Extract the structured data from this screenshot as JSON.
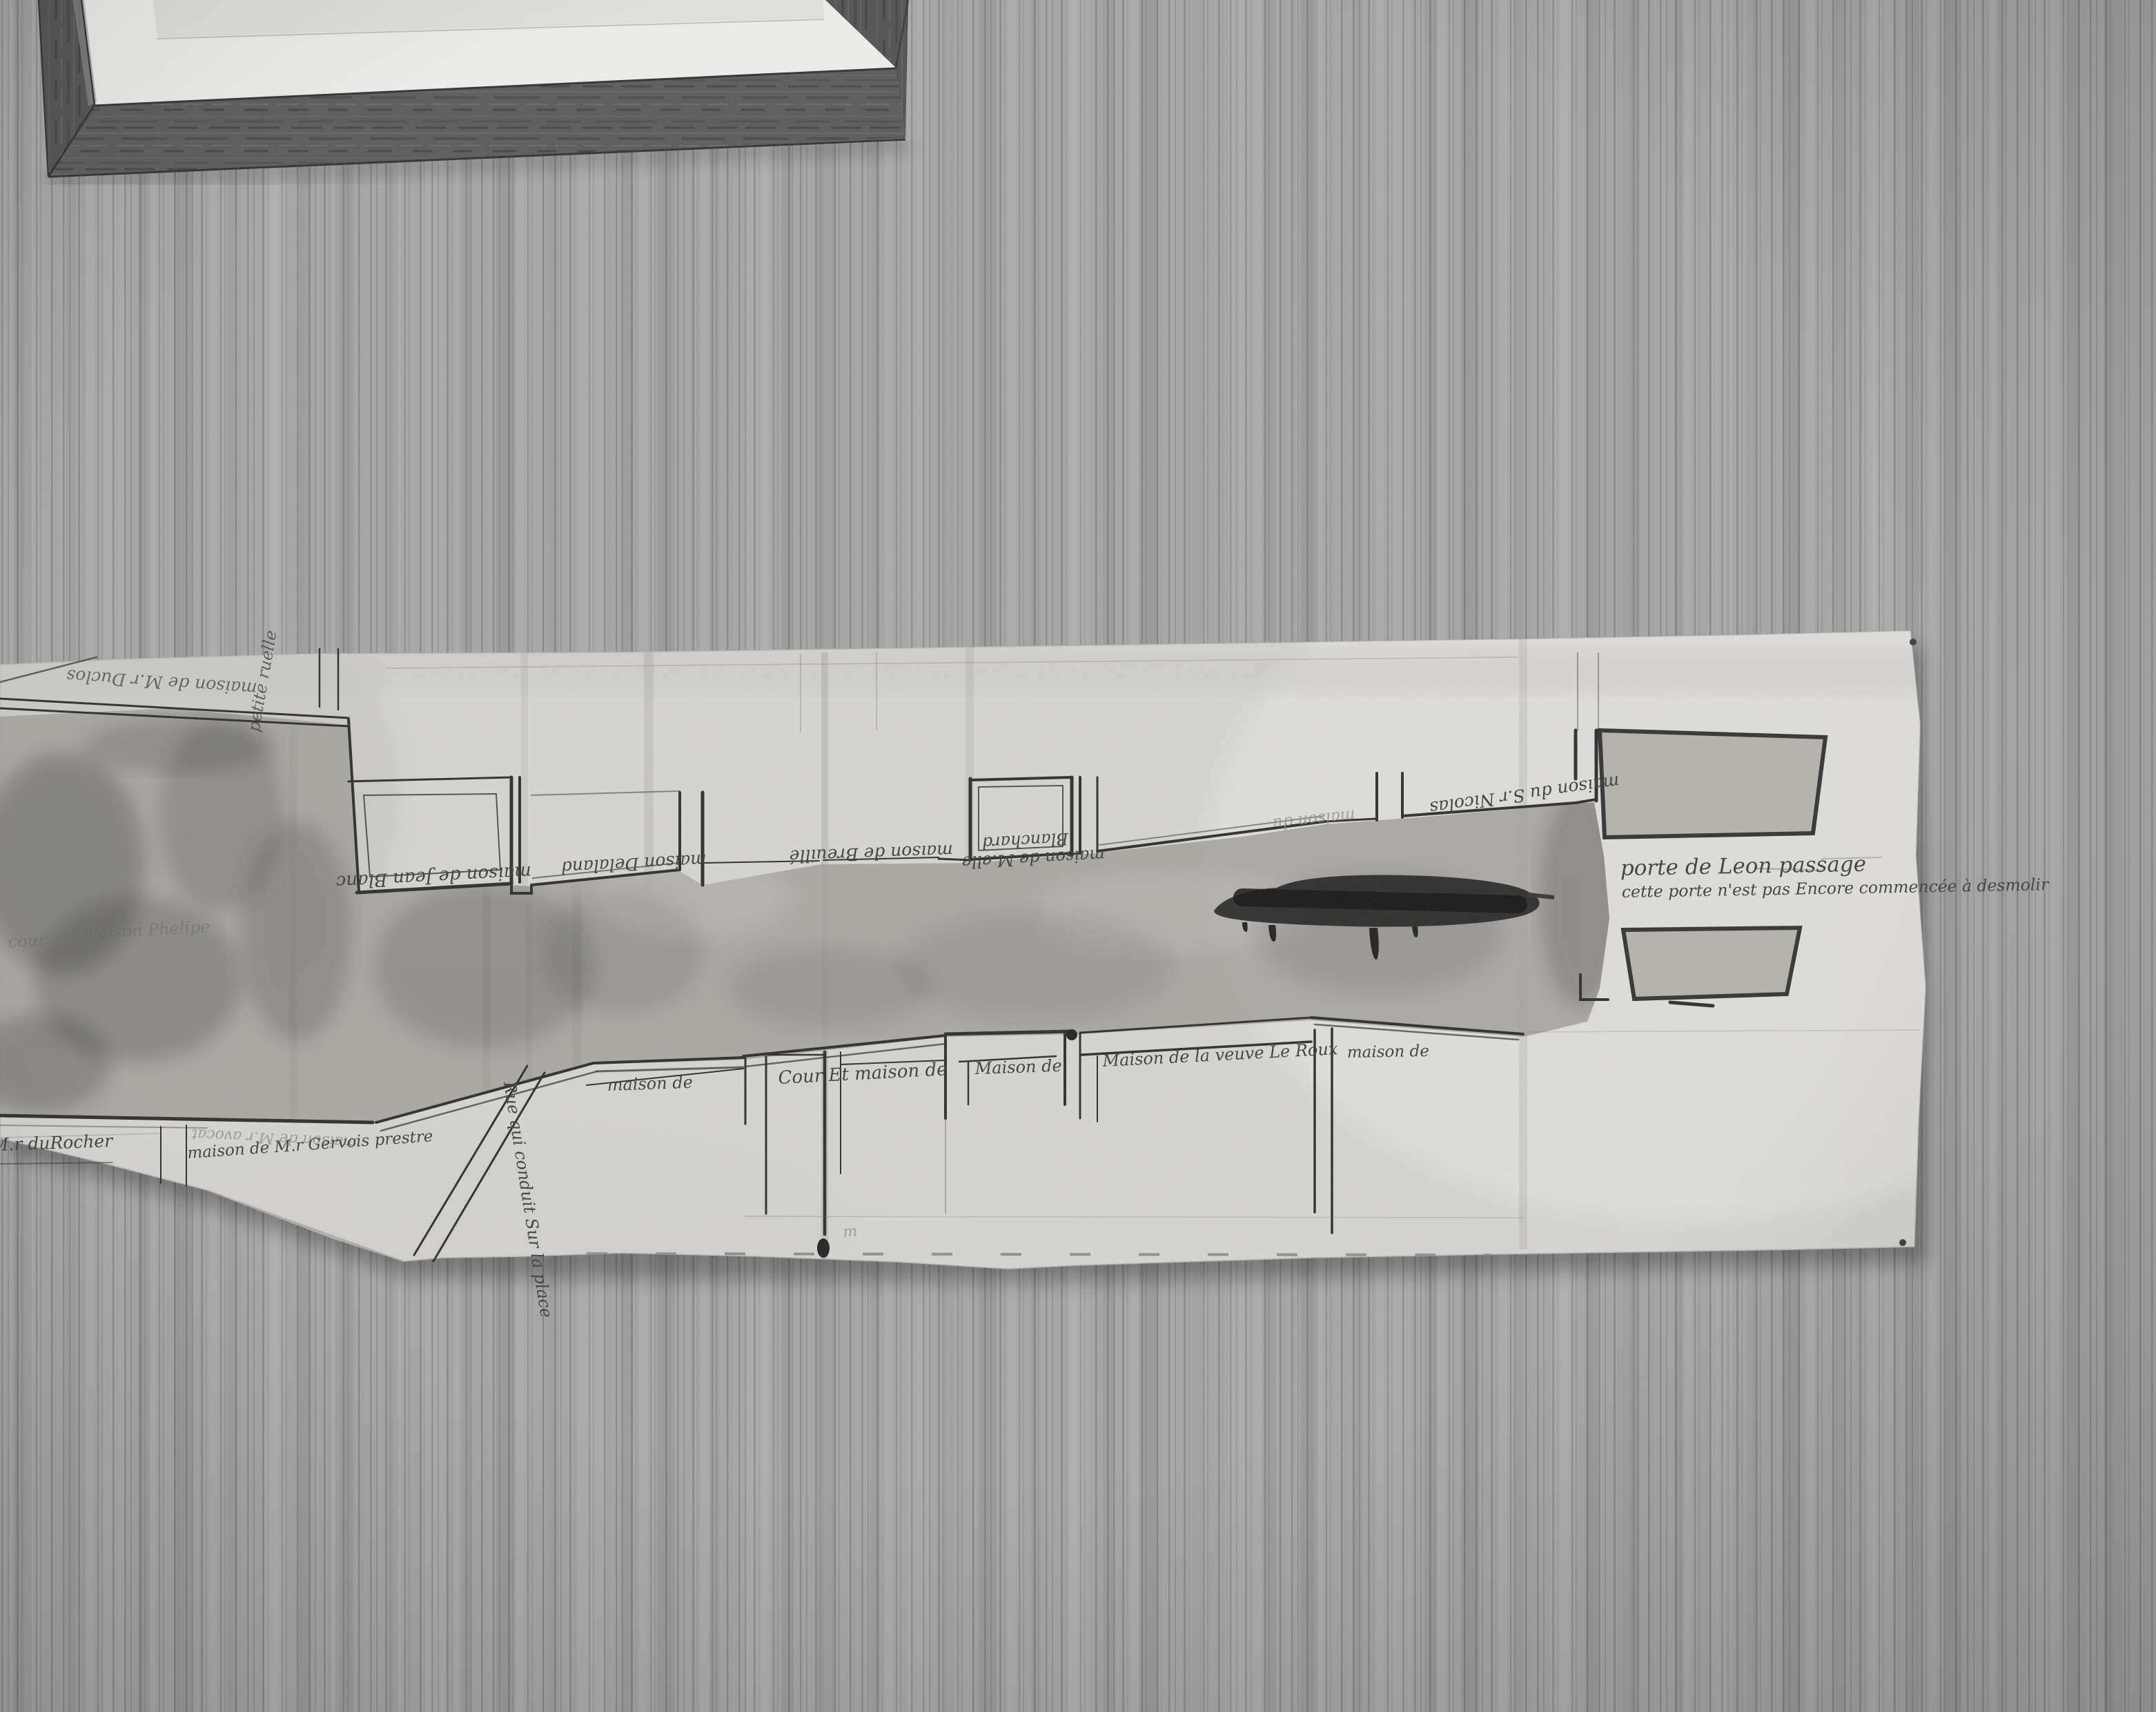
{
  "wallpaper": {
    "base_color": "#a6a6a6",
    "stripe_color": "#6e6e6e"
  },
  "picture_frame": {
    "wood_color": "#565656",
    "mat_color": "#f0f0ee",
    "art_edge_color": "#e2e2e0"
  },
  "plan": {
    "paper_color": "#d7d6d2",
    "wash_color": "#a09e98",
    "ink_color": "#2a2a2a",
    "blob_color": "#1e1e1e",
    "pinhole_count": 2
  },
  "labels": [
    {
      "id": "maison-duclos",
      "text": "maison de M.r Duclos"
    },
    {
      "id": "petite-ruelle",
      "text": "petite ruelle"
    },
    {
      "id": "jean-blanc",
      "text": "maison de Jean Blanc"
    },
    {
      "id": "delaland",
      "text": "maison Delaland"
    },
    {
      "id": "breuille",
      "text": "maison de Breuillé"
    },
    {
      "id": "blanchard-1",
      "text": "maison de M.elle"
    },
    {
      "id": "blanchard-2",
      "text": "Blanchard"
    },
    {
      "id": "maison-du",
      "text": "maison du"
    },
    {
      "id": "nicolas",
      "text": "maison du S.r Nicolas"
    },
    {
      "id": "porte-leon",
      "text": "porte de Leon passage"
    },
    {
      "id": "porte-note",
      "text": "cette porte n'est pas Encore commencée à desmolir"
    },
    {
      "id": "maison-de-1",
      "text": "maison de"
    },
    {
      "id": "cour-et-maison",
      "text": "Cour Et maison de"
    },
    {
      "id": "maison-de-2",
      "text": "Maison de"
    },
    {
      "id": "veuve-le-roux",
      "text": "Maison de la veuve Le Roux"
    },
    {
      "id": "maison-de-3",
      "text": "maison de"
    },
    {
      "id": "du-rocher",
      "text": "maison de M.r duRocher"
    },
    {
      "id": "avocat",
      "text": "maison de M.r avocat"
    },
    {
      "id": "gervois",
      "text": "maison de M.r Gervois prestre"
    },
    {
      "id": "rue-place",
      "text": "Rue qui conduit Sur la place"
    },
    {
      "id": "cour",
      "text": "cour"
    },
    {
      "id": "phelipe",
      "text": "maison Phelipe"
    },
    {
      "id": "mark-m",
      "text": "m"
    }
  ]
}
